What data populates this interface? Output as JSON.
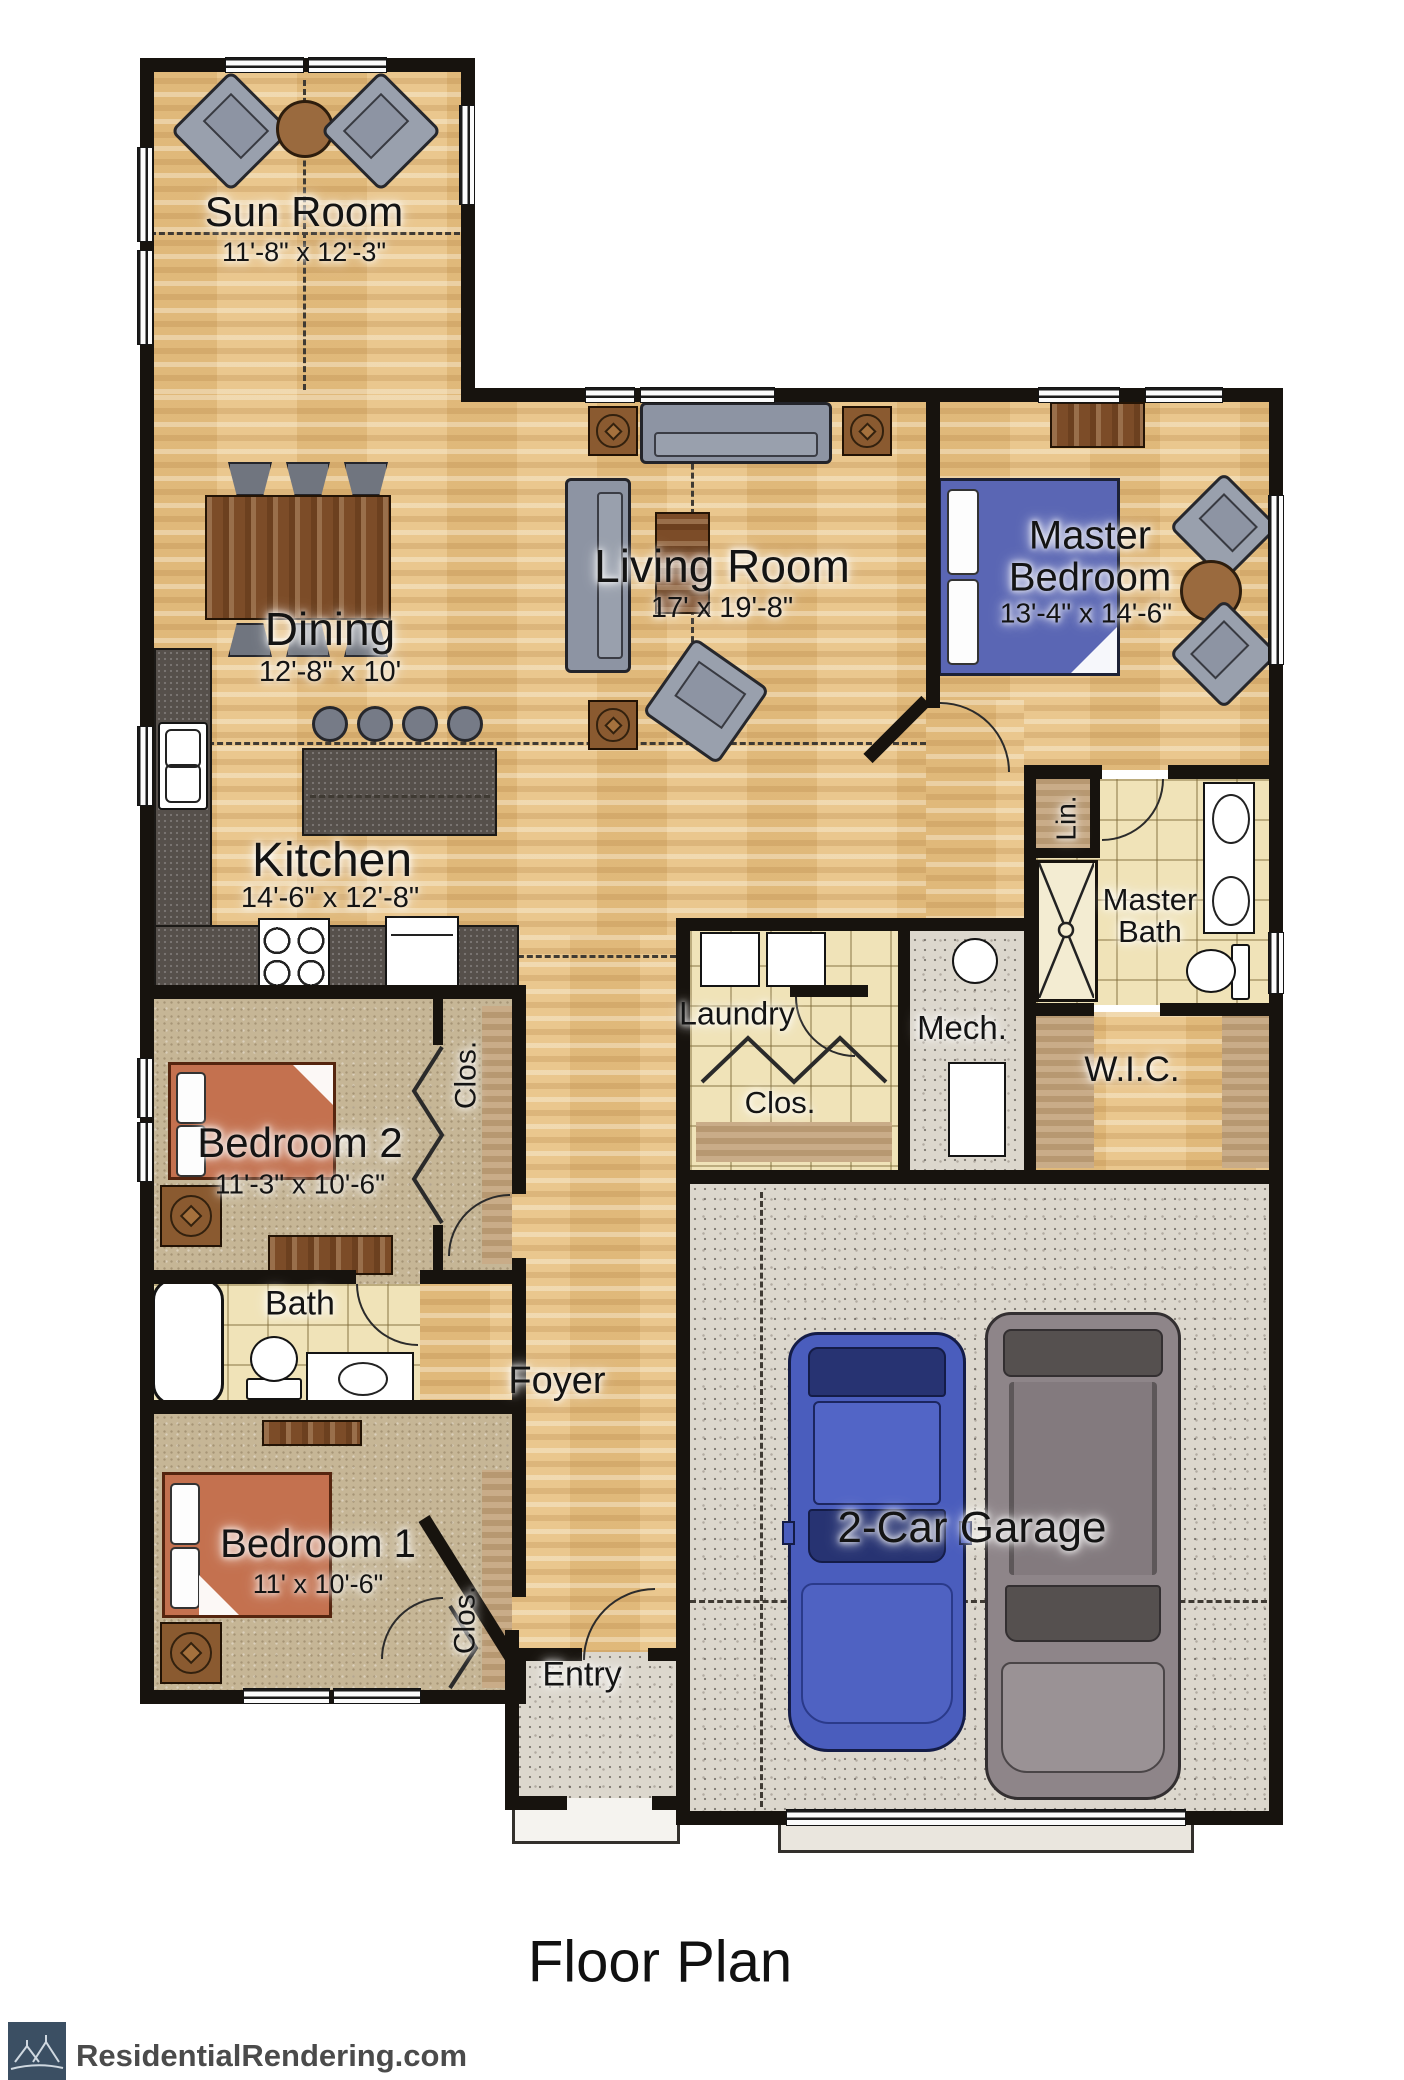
{
  "rooms": {
    "sun_room": {
      "name": "Sun Room",
      "dims": "11'-8\" x 12'-3\""
    },
    "dining": {
      "name": "Dining",
      "dims": "12'-8\" x 10'"
    },
    "living": {
      "name": "Living Room",
      "dims": "17' x 19'-8\""
    },
    "master_bedroom": {
      "name": "Master Bedroom",
      "dims": "13'-4\" x 14'-6\""
    },
    "kitchen": {
      "name": "Kitchen",
      "dims": "14'-6\" x 12'-8\""
    },
    "laundry": {
      "name": "Laundry",
      "closet": "Clos."
    },
    "mech": {
      "name": "Mech."
    },
    "linen": {
      "name": "Lin."
    },
    "master_bath": {
      "name": "Master Bath"
    },
    "wic": {
      "name": "W.I.C."
    },
    "bedroom2": {
      "name": "Bedroom 2",
      "dims": "11'-3\" x 10'-6\"",
      "closet": "Clos."
    },
    "bath": {
      "name": "Bath"
    },
    "foyer": {
      "name": "Foyer"
    },
    "bedroom1": {
      "name": "Bedroom 1",
      "dims": "11' x 10'-6\"",
      "closet": "Clos."
    },
    "entry": {
      "name": "Entry"
    },
    "garage": {
      "name": "2-Car Garage"
    }
  },
  "footer": {
    "title": "Floor Plan",
    "brand": "ResidentialRendering.com"
  },
  "colors": {
    "wall": "#17130e",
    "wood_floor": "#e6c083",
    "carpet": "#c6b696",
    "tile": "#f0e3b8",
    "concrete": "#dcd7cd",
    "counter": "#56504b",
    "bed_blue": "#5a66b4",
    "bed_terracotta": "#c4714f",
    "sofa_gray": "#8d94a3",
    "table_brown": "#7c4c28",
    "car_blue": "#4a5dbd",
    "suv_gray": "#8e8589",
    "logo_blue": "#3b4f63"
  }
}
